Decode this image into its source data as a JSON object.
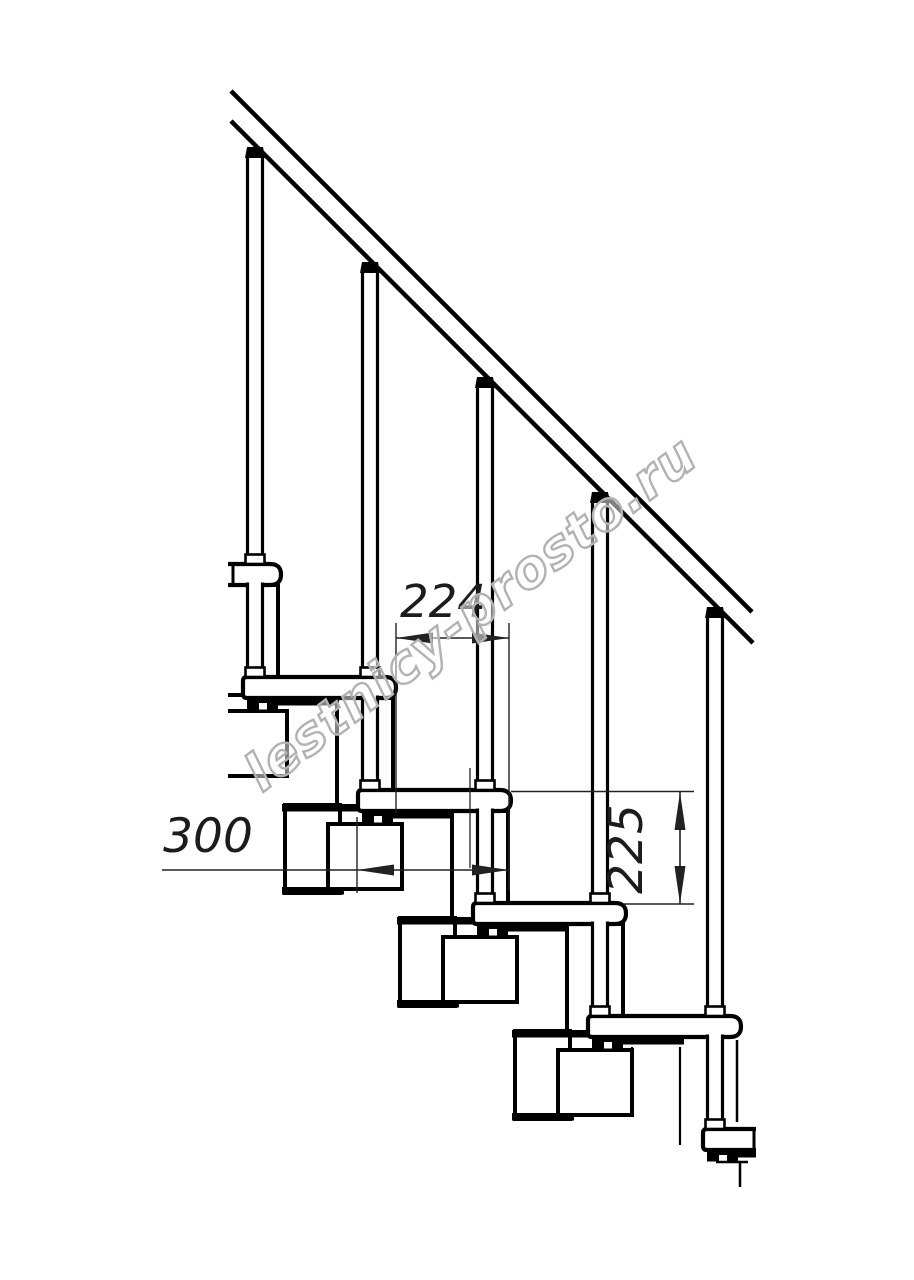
{
  "page": {
    "background": "#ffffff"
  },
  "drawing": {
    "type": "technical-line-drawing",
    "subject": "modular staircase side elevation with handrail and balusters",
    "watermark": {
      "text": "lestnicy-prosto.ru",
      "color": "#b2b2b2"
    },
    "dimensions": [
      {
        "id": "going",
        "value": "224",
        "orientation": "horizontal"
      },
      {
        "id": "tread-depth",
        "value": "300",
        "orientation": "horizontal"
      },
      {
        "id": "rise",
        "value": "225",
        "orientation": "vertical"
      }
    ],
    "colors": {
      "line": "#000000",
      "dimension_line": "#222222",
      "background": "#ffffff"
    }
  }
}
